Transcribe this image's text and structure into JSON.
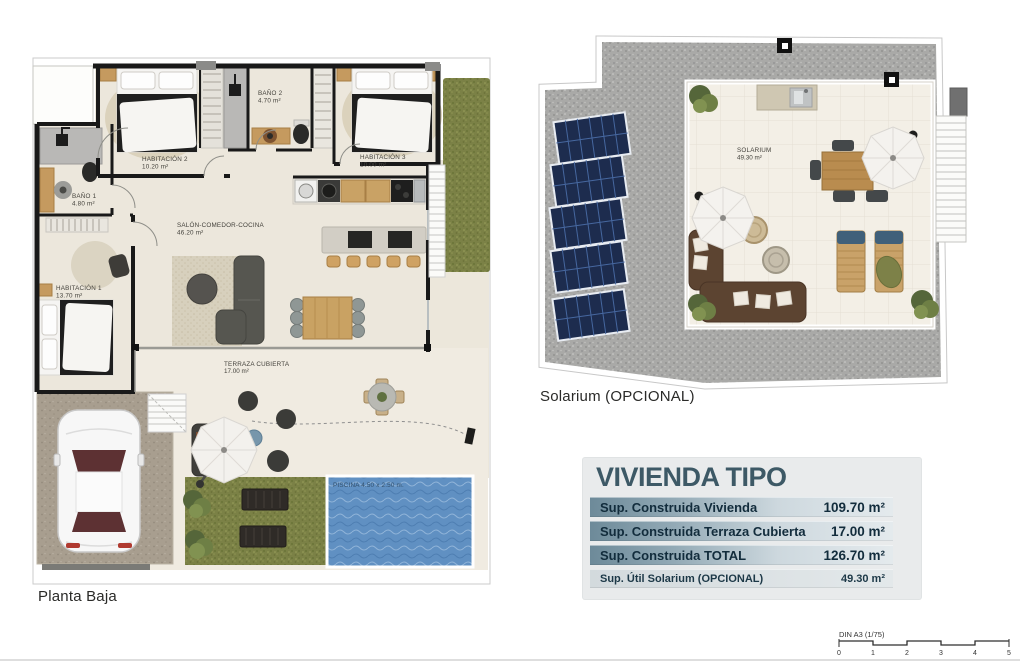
{
  "planta_baja": {
    "title": "Planta Baja",
    "rooms": {
      "habitacion2": {
        "name": "HABITACIÓN 2",
        "area": "10.20 m²"
      },
      "bano2": {
        "name": "BAÑO 2",
        "area": "4.70 m²"
      },
      "habitacion3": {
        "name": "HABITACIÓN 3",
        "area": "10.00 m²"
      },
      "bano1": {
        "name": "BAÑO 1",
        "area": "4.80 m²"
      },
      "habitacion1": {
        "name": "HABITACIÓN 1",
        "area": "13.70 m²"
      },
      "salon": {
        "name": "SALÓN-COMEDOR-COCINA",
        "area": "46.20 m²"
      },
      "terraza": {
        "name": "TERRAZA CUBIERTA",
        "area": "17.00 m²"
      }
    },
    "piscina_label": "PISCINA 4.50 x 2.50 m."
  },
  "solarium": {
    "title": "Solarium (OPCIONAL)",
    "room": {
      "name": "SOLARIUM",
      "area": "49.30 m²"
    }
  },
  "vivienda_tipo": {
    "title": "VIVIENDA TIPO",
    "rows": [
      {
        "label": "Sup. Construida Vivienda",
        "value": "109.70 m²"
      },
      {
        "label": "Sup. Construida Terraza Cubierta",
        "value": "17.00 m²"
      },
      {
        "label": "Sup. Construida TOTAL",
        "value": "126.70 m²"
      }
    ],
    "util_row": {
      "label": "Sup. Útil Solarium (OPCIONAL)",
      "value": "49.30 m²"
    }
  },
  "scale": {
    "label": "DIN A3 (1/75)",
    "ticks": [
      "0",
      "1",
      "2",
      "3",
      "4",
      "5"
    ]
  },
  "colors": {
    "wall": "#191919",
    "floor_beige": "#ece7dc",
    "terrace_beige": "#f0ebe1",
    "grass_green": "#7b8146",
    "gravel_gray": "#a9a9a7",
    "pool_blue": "#6090c2",
    "pool_label_text": "#33506b",
    "solar_panel_navy": "#1d2c4e",
    "table_title": "#3d5966",
    "row_gradient_start": "#6d8a99",
    "row_gradient_end": "#e4eaed",
    "row_text": "#122c3c"
  }
}
